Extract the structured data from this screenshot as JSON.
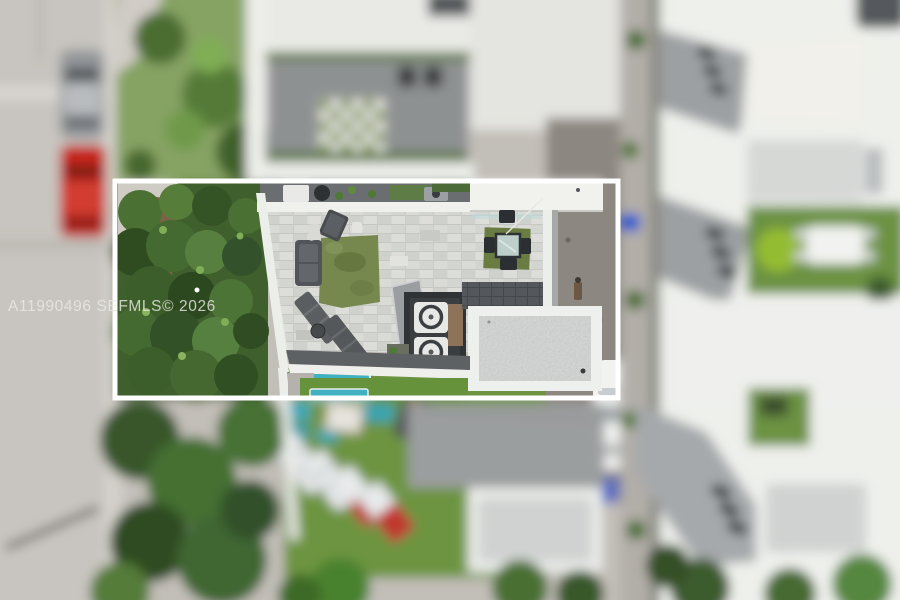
{
  "image": {
    "kind": "aerial-drone-real-estate-photo",
    "description": "Overhead aerial view of a modern townhouse; a white rectangle highlights the sharp rooftop terrace while surroundings are blurred",
    "width_px": 900,
    "height_px": 600
  },
  "watermark": {
    "text": "A11990496  SEFMLS© 2026",
    "color": "#e9e9e3"
  },
  "highlight_box": {
    "x": 115,
    "y": 181,
    "width": 503,
    "height": 217,
    "border_color": "#ffffff",
    "border_width": 5
  },
  "scene": {
    "focused_area_label": "rooftop terrace",
    "features": {
      "terrace": "paver rooftop terrace",
      "turf_rug": "green artificial turf rug",
      "sofa": "dark outdoor sofa",
      "sun_loungers": "two dark sun loungers",
      "dining_set": "glass dining table with four chairs on turf mat",
      "ac_units": "two rooftop AC condenser units in enclosure",
      "flat_roof": "white-bordered concrete flat roof",
      "front_deck": "front deck strip with grill",
      "trees": "dense green tree canopy",
      "street": "street with parked silver and red cars",
      "neighbor_patio": "neighboring patio with green checkerboard rug",
      "backyard": "backyard lawn with pool, mats and striped loungers",
      "right_buildings": "white townhouse rooftops with lawn and dining table"
    }
  },
  "colors": {
    "pavers": "#d6d7d3",
    "turf": "#77884e",
    "lawn": "#6d9440",
    "pool_teal": "#41b0c0",
    "red_car": "#c6271f",
    "silver_car": "#93969a",
    "building_white": "#eef0ec",
    "deck_gray": "#9b9ea1",
    "driveway": "#8d8781",
    "tree_dark": "#33512a",
    "tree_light": "#6f9a4a",
    "dark_furniture": "#515458"
  }
}
